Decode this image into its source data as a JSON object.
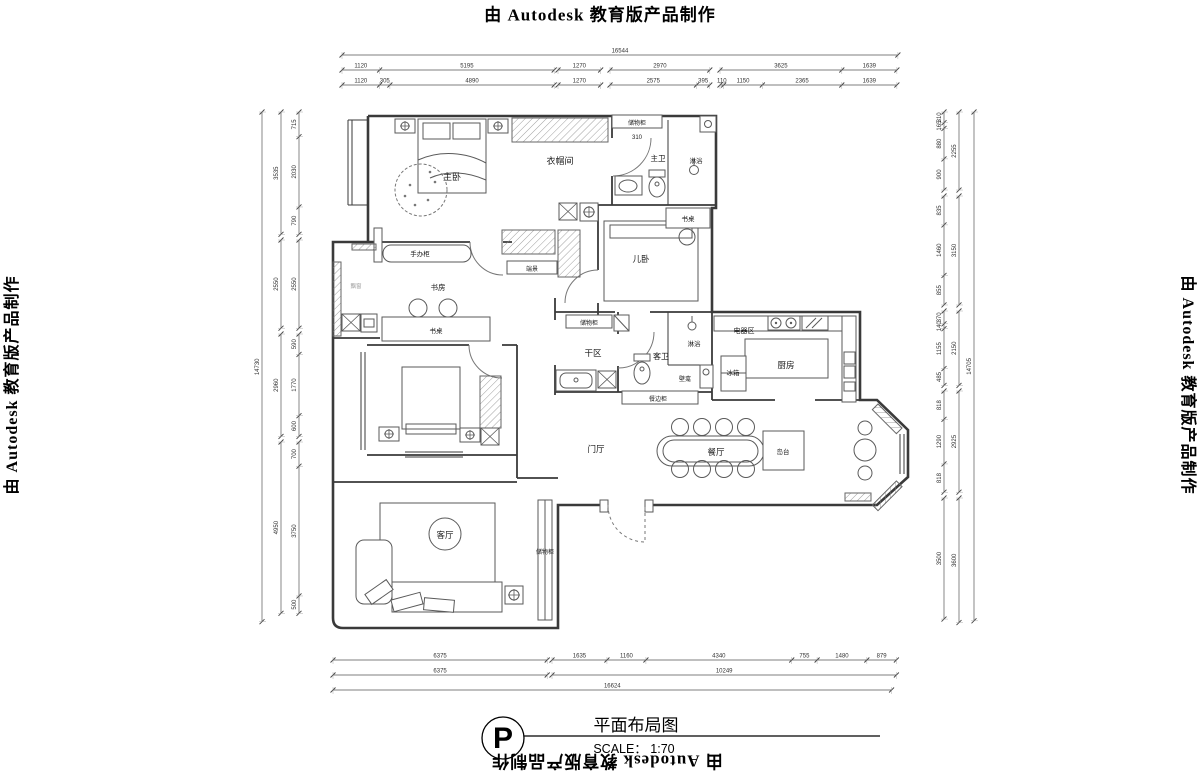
{
  "watermark": {
    "text": "由 Autodesk 教育版产品制作"
  },
  "title_block": {
    "north_symbol": "P",
    "title": "平面布局图",
    "scale": "SCALE： 1:70"
  },
  "plan": {
    "labels": [
      {
        "text": "主卧",
        "x": 452,
        "y": 180,
        "size": 9
      },
      {
        "text": "衣帽间",
        "x": 560,
        "y": 164,
        "size": 9
      },
      {
        "text": "储物柜",
        "x": 637,
        "y": 125,
        "size": 6
      },
      {
        "text": "310",
        "x": 637,
        "y": 139,
        "size": 6
      },
      {
        "text": "主卫",
        "x": 658,
        "y": 161,
        "size": 7.5
      },
      {
        "text": "淋浴",
        "x": 696,
        "y": 163,
        "size": 6.5
      },
      {
        "text": "书桌",
        "x": 688,
        "y": 221,
        "size": 6.5
      },
      {
        "text": "手办柜",
        "x": 420,
        "y": 256,
        "size": 6.5
      },
      {
        "text": "书房",
        "x": 438,
        "y": 290,
        "size": 7.5
      },
      {
        "text": "飘窗",
        "x": 356,
        "y": 288,
        "size": 5.5,
        "color": "#999999"
      },
      {
        "text": "端景",
        "x": 532,
        "y": 271,
        "size": 6
      },
      {
        "text": "儿卧",
        "x": 641,
        "y": 262,
        "size": 8.5
      },
      {
        "text": "书桌",
        "x": 436,
        "y": 333,
        "size": 6.5
      },
      {
        "text": "储物柜",
        "x": 589,
        "y": 325,
        "size": 6
      },
      {
        "text": "干区",
        "x": 593,
        "y": 356,
        "size": 8.5
      },
      {
        "text": "客卫",
        "x": 661,
        "y": 359,
        "size": 8
      },
      {
        "text": "淋浴",
        "x": 694,
        "y": 346,
        "size": 6.5
      },
      {
        "text": "壁龛",
        "x": 685,
        "y": 381,
        "size": 6
      },
      {
        "text": "餐边柜",
        "x": 658,
        "y": 401,
        "size": 6
      },
      {
        "text": "电器区",
        "x": 744,
        "y": 333,
        "size": 7
      },
      {
        "text": "冰箱",
        "x": 733,
        "y": 375,
        "size": 6.5
      },
      {
        "text": "厨房",
        "x": 786,
        "y": 368,
        "size": 8.5
      },
      {
        "text": "门厅",
        "x": 596,
        "y": 452,
        "size": 8.5
      },
      {
        "text": "餐厅",
        "x": 716,
        "y": 455,
        "size": 8.5
      },
      {
        "text": "岛台",
        "x": 783,
        "y": 454,
        "size": 6.5
      },
      {
        "text": "客厅",
        "x": 445,
        "y": 538,
        "size": 8.5
      },
      {
        "text": "储物柜",
        "x": 545,
        "y": 554,
        "size": 6
      }
    ]
  },
  "dims": {
    "px_per_mm_h": 0.0336,
    "px_per_mm_v": 0.0346,
    "h": [
      {
        "y": 55,
        "x": 342,
        "mm": [
          16544
        ]
      },
      {
        "y": 70,
        "x": 342,
        "mm": [
          1120,
          5195
        ]
      },
      {
        "y": 70,
        "x": 558,
        "mm": [
          1270
        ]
      },
      {
        "y": 70,
        "x": 610,
        "mm": [
          2970
        ]
      },
      {
        "y": 70,
        "x": 720,
        "mm": [
          3625,
          1639
        ]
      },
      {
        "y": 85,
        "x": 342,
        "mm": [
          1120,
          305,
          4890
        ]
      },
      {
        "y": 85,
        "x": 558,
        "mm": [
          1270
        ]
      },
      {
        "y": 85,
        "x": 610,
        "mm": [
          2575,
          395
        ]
      },
      {
        "y": 85,
        "x": 720,
        "mm": [
          110,
          1150,
          2365,
          1639
        ]
      },
      {
        "y": 660,
        "x": 333,
        "mm": [
          6375
        ]
      },
      {
        "y": 660,
        "x": 552,
        "mm": [
          1635,
          1160,
          4340,
          755,
          1480,
          879
        ]
      },
      {
        "y": 675,
        "x": 333,
        "mm": [
          6375
        ]
      },
      {
        "y": 675,
        "x": 552,
        "mm": [
          10249
        ]
      },
      {
        "y": 690,
        "x": 333,
        "mm": [
          16624
        ]
      }
    ],
    "v": [
      {
        "x": 262,
        "y": 112,
        "mm": [
          14730
        ]
      },
      {
        "x": 281,
        "y": 112,
        "mm": [
          3535
        ]
      },
      {
        "x": 281,
        "y": 240,
        "mm": [
          2550
        ]
      },
      {
        "x": 281,
        "y": 334,
        "mm": [
          2960
        ]
      },
      {
        "x": 281,
        "y": 442,
        "mm": [
          4950
        ]
      },
      {
        "x": 299,
        "y": 112,
        "mm": [
          715,
          2030,
          790
        ]
      },
      {
        "x": 299,
        "y": 240,
        "mm": [
          2550
        ]
      },
      {
        "x": 299,
        "y": 334,
        "mm": [
          590,
          1770,
          600
        ]
      },
      {
        "x": 299,
        "y": 442,
        "mm": [
          700,
          3750,
          500
        ]
      },
      {
        "x": 944,
        "y": 112,
        "mm": [
          310,
          165,
          880,
          900
        ]
      },
      {
        "x": 944,
        "y": 196,
        "mm": [
          835,
          1460,
          855
        ]
      },
      {
        "x": 944,
        "y": 311,
        "mm": [
          370,
          140,
          1155,
          485
        ]
      },
      {
        "x": 944,
        "y": 391,
        "mm": [
          818,
          1290,
          818
        ]
      },
      {
        "x": 944,
        "y": 498,
        "mm": [
          3500
        ]
      },
      {
        "x": 959,
        "y": 112,
        "mm": [
          2255
        ]
      },
      {
        "x": 959,
        "y": 196,
        "mm": [
          3150
        ]
      },
      {
        "x": 959,
        "y": 311,
        "mm": [
          2150
        ]
      },
      {
        "x": 959,
        "y": 391,
        "mm": [
          2925
        ]
      },
      {
        "x": 959,
        "y": 498,
        "mm": [
          3600
        ]
      },
      {
        "x": 974,
        "y": 112,
        "mm": [
          14705
        ]
      }
    ]
  }
}
